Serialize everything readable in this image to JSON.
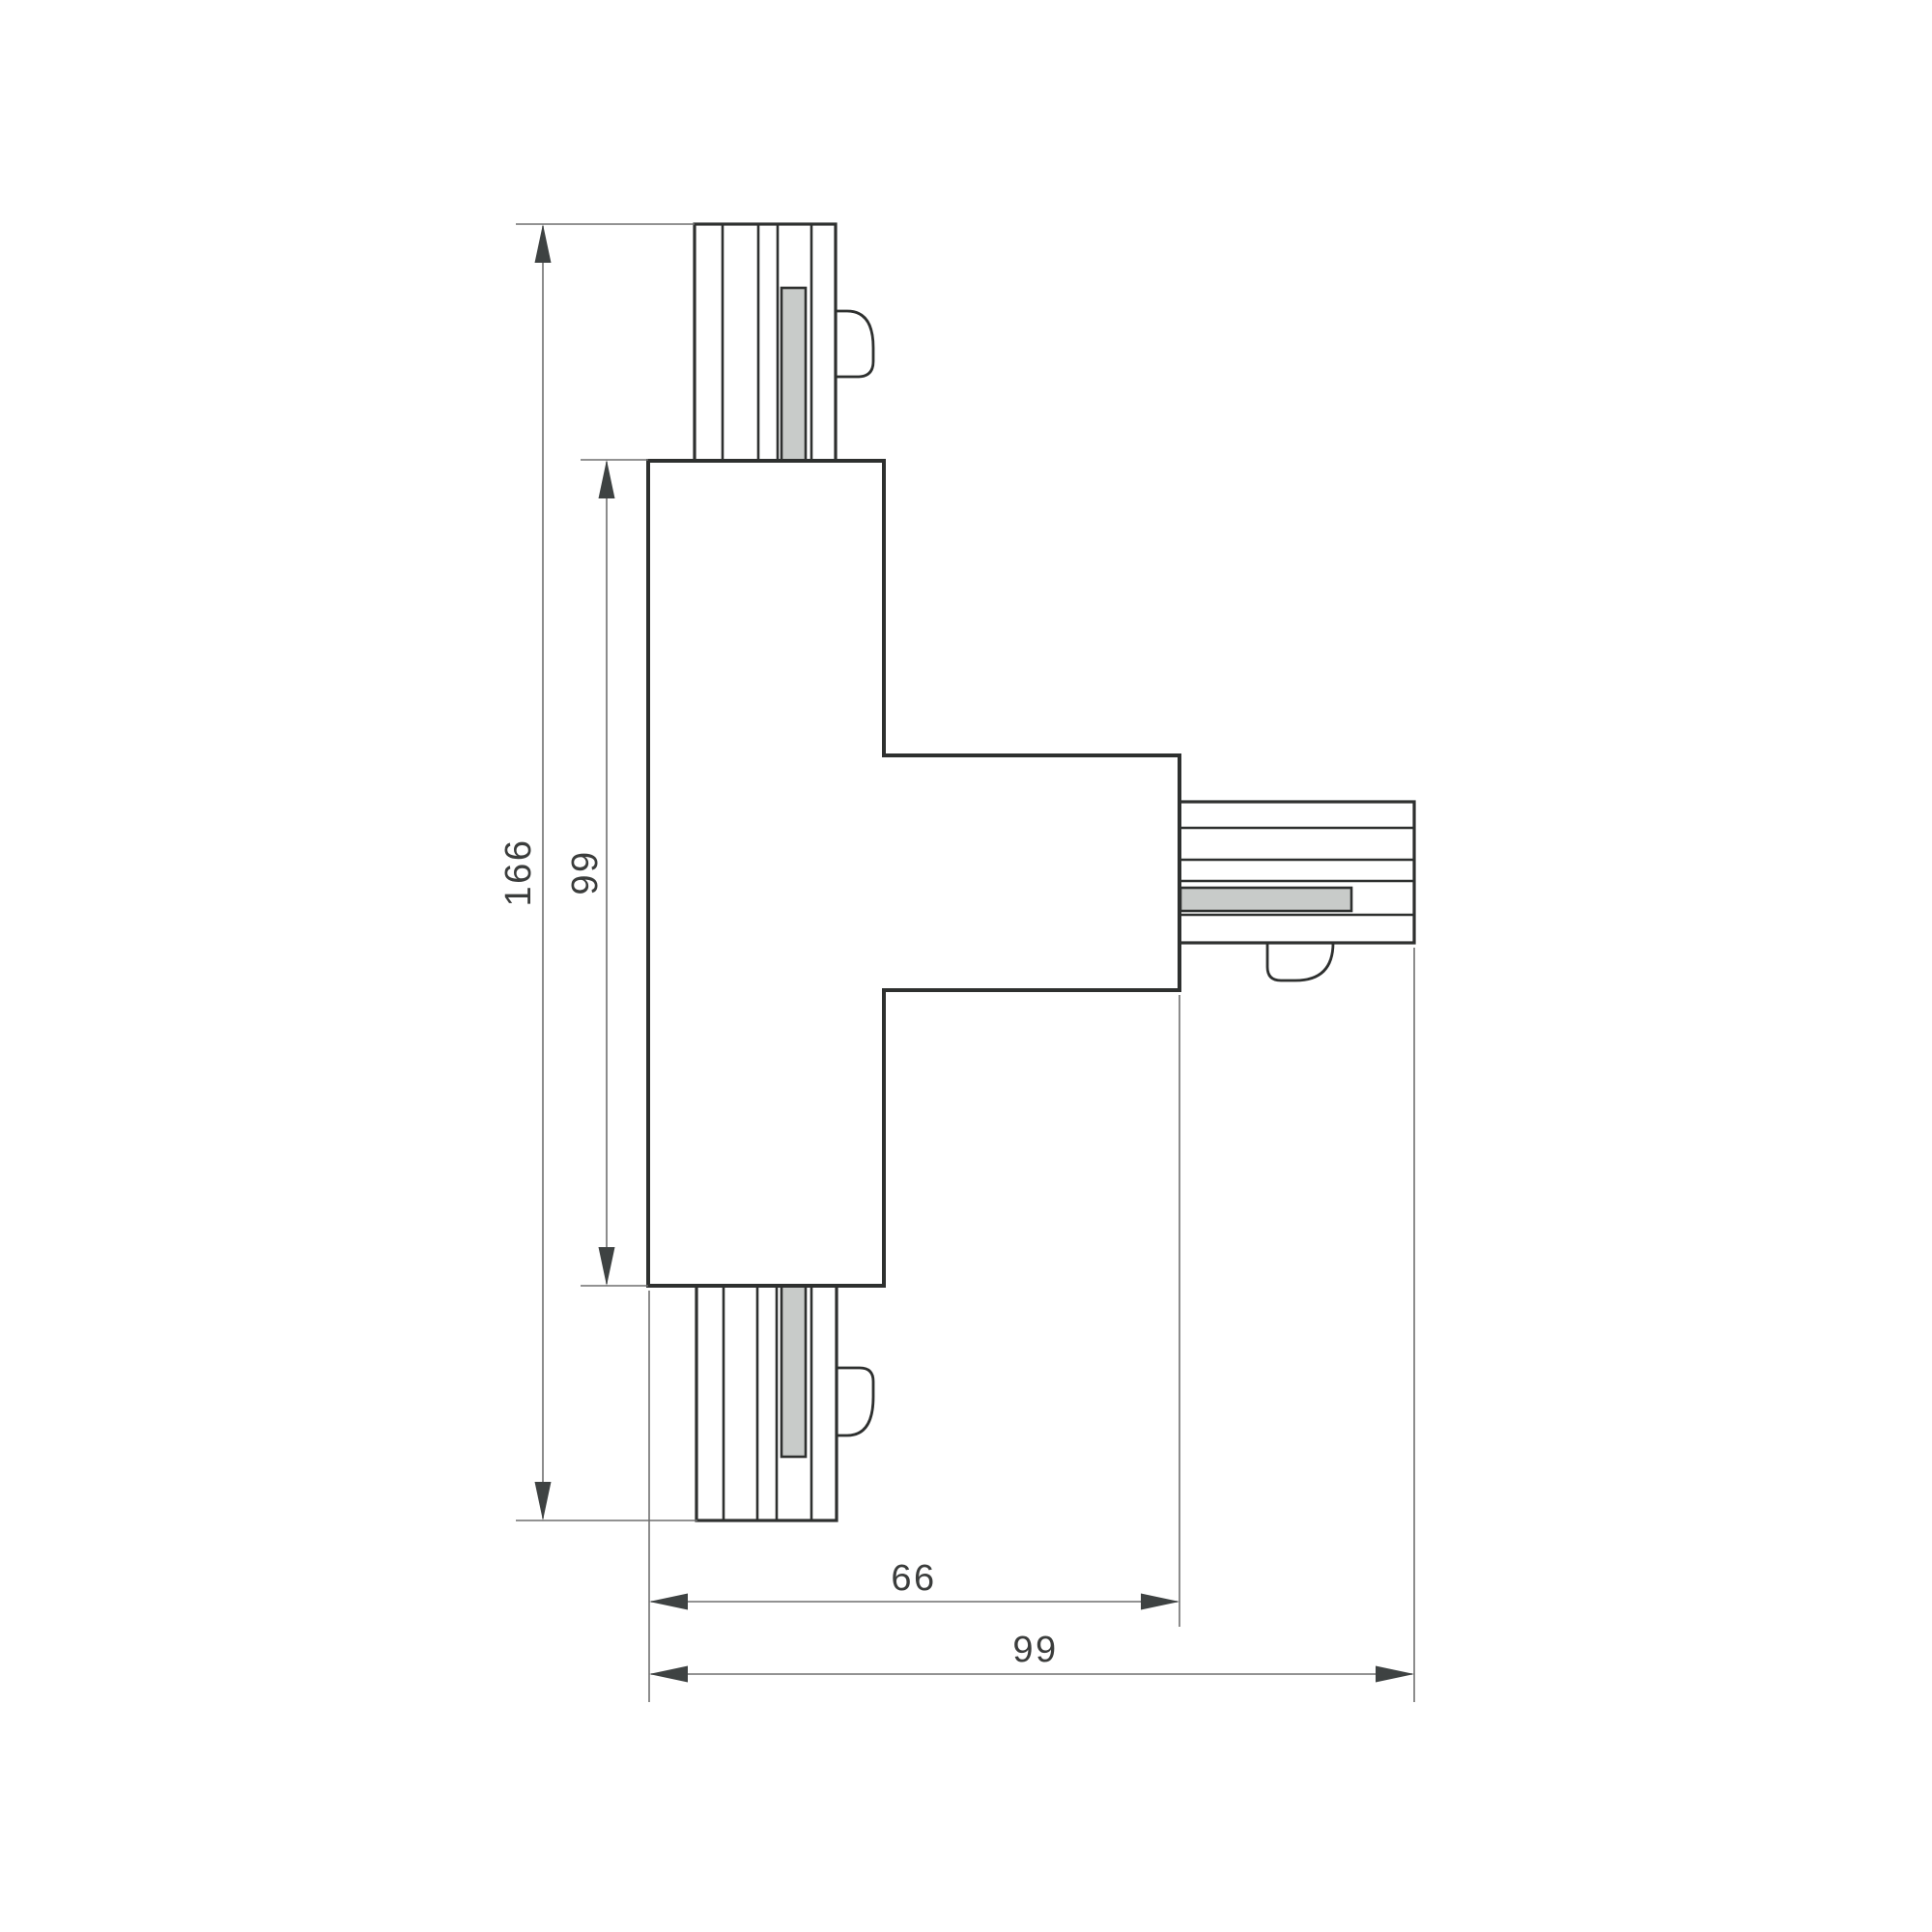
{
  "drawing": {
    "kind": "technical-dimension-drawing",
    "part": "t-shaped-track-connector"
  },
  "dimensions": {
    "overall_height": "166",
    "body_height": "99",
    "body_and_arm_width": "66",
    "overall_width": "99"
  },
  "colors": {
    "background": "#ffffff",
    "line": "#2e302f",
    "dim_line": "#6f6f6f",
    "arrow": "#3e4242",
    "insert_fill": "#c8cbc9",
    "label": "#3b3d3c"
  }
}
